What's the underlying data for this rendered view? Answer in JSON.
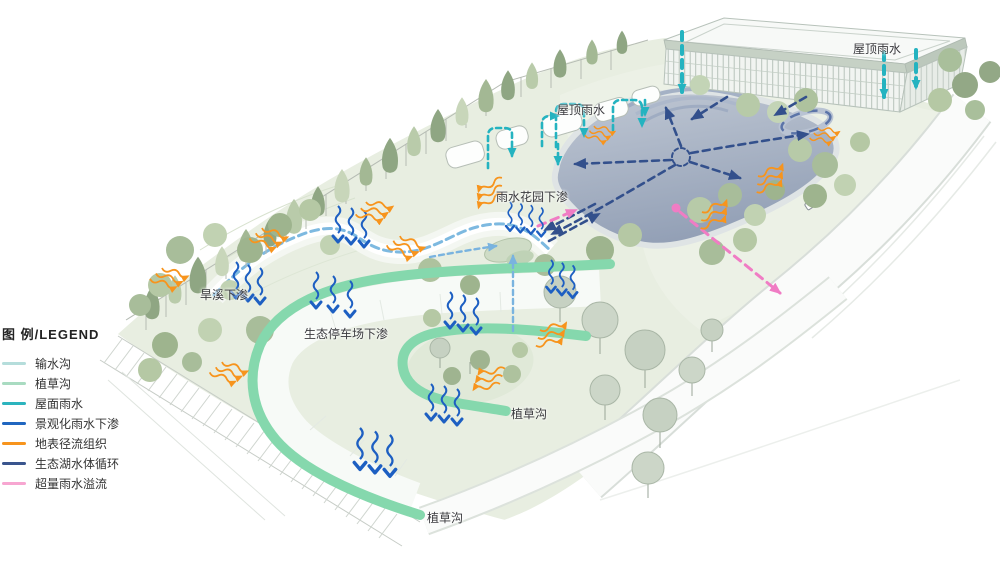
{
  "legend": {
    "title": "图 例/LEGEND",
    "items": [
      {
        "label": "输水沟",
        "color": "#b5dddb"
      },
      {
        "label": "植草沟",
        "color": "#a9dbc1"
      },
      {
        "label": "屋面雨水",
        "color": "#2cb4be"
      },
      {
        "label": "景观化雨水下渗",
        "color": "#2066c0"
      },
      {
        "label": "地表径流组织",
        "color": "#f7941d"
      },
      {
        "label": "生态湖水体循环",
        "color": "#3a558e"
      },
      {
        "label": "超量雨水溢流",
        "color": "#f7a6d1"
      }
    ]
  },
  "map_labels": [
    {
      "id": "roof-rain-right",
      "text": "屋顶雨水",
      "x": 853,
      "y": 40
    },
    {
      "id": "roof-rain-mid",
      "text": "屋顶雨水",
      "x": 557,
      "y": 101
    },
    {
      "id": "rain-garden-infiltration",
      "text": "雨水花园下渗",
      "x": 496,
      "y": 188
    },
    {
      "id": "dry-creek-infiltration",
      "text": "旱溪下渗",
      "x": 200,
      "y": 286
    },
    {
      "id": "eco-parking-infiltration",
      "text": "生态停车场下渗",
      "x": 304,
      "y": 325
    },
    {
      "id": "grass-swale-upper",
      "text": "植草沟",
      "x": 511,
      "y": 405
    },
    {
      "id": "grass-swale-lower",
      "text": "植草沟",
      "x": 427,
      "y": 509
    }
  ],
  "colors": {
    "teal": "#24b3c0",
    "blue": "#1d5fc2",
    "navy": "#33508c",
    "orange": "#f7941d",
    "pink": "#f07cc4",
    "ltblue": "#79b3df",
    "mint": "#85d8ad",
    "creek": "#7db9e0"
  }
}
